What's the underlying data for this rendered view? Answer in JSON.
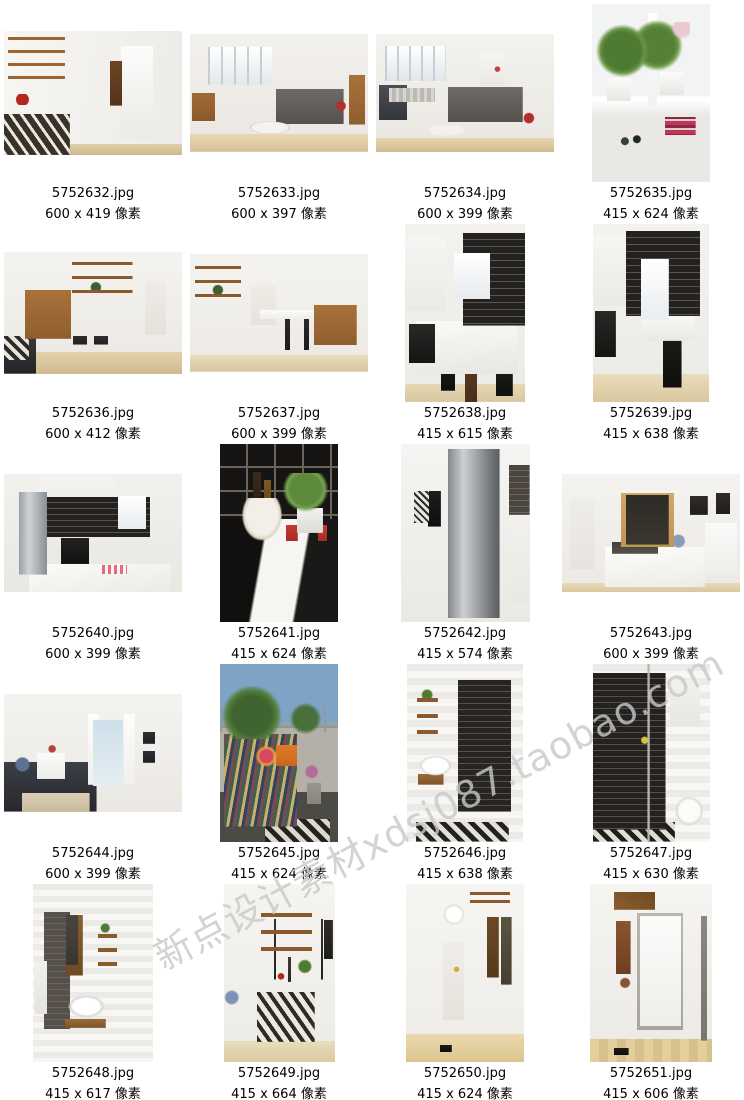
{
  "page": {
    "background": "#ffffff",
    "text_color": "#000000"
  },
  "watermark": {
    "text": "新点设计素材xdsj087.taobao.com",
    "color": "#c9c9c9"
  },
  "unit_label": "像素",
  "items": [
    {
      "filename": "5752632.jpg",
      "dims_label": "600 x 419 像素",
      "width": 600,
      "height": 419
    },
    {
      "filename": "5752633.jpg",
      "dims_label": "600 x 397 像素",
      "width": 600,
      "height": 397
    },
    {
      "filename": "5752634.jpg",
      "dims_label": "600 x 399 像素",
      "width": 600,
      "height": 399
    },
    {
      "filename": "5752635.jpg",
      "dims_label": "415 x 624 像素",
      "width": 415,
      "height": 624
    },
    {
      "filename": "5752636.jpg",
      "dims_label": "600 x 412 像素",
      "width": 600,
      "height": 412
    },
    {
      "filename": "5752637.jpg",
      "dims_label": "600 x 399 像素",
      "width": 600,
      "height": 399
    },
    {
      "filename": "5752638.jpg",
      "dims_label": "415 x 615 像素",
      "width": 415,
      "height": 615
    },
    {
      "filename": "5752639.jpg",
      "dims_label": "415 x 638 像素",
      "width": 415,
      "height": 638
    },
    {
      "filename": "5752640.jpg",
      "dims_label": "600 x 399 像素",
      "width": 600,
      "height": 399
    },
    {
      "filename": "5752641.jpg",
      "dims_label": "415 x 624 像素",
      "width": 415,
      "height": 624
    },
    {
      "filename": "5752642.jpg",
      "dims_label": "415 x 574 像素",
      "width": 415,
      "height": 574
    },
    {
      "filename": "5752643.jpg",
      "dims_label": "600 x 399 像素",
      "width": 600,
      "height": 399
    },
    {
      "filename": "5752644.jpg",
      "dims_label": "600 x 399 像素",
      "width": 600,
      "height": 399
    },
    {
      "filename": "5752645.jpg",
      "dims_label": "415 x 624 像素",
      "width": 415,
      "height": 624
    },
    {
      "filename": "5752646.jpg",
      "dims_label": "415 x 638 像素",
      "width": 415,
      "height": 638
    },
    {
      "filename": "5752647.jpg",
      "dims_label": "415 x 630 像素",
      "width": 415,
      "height": 630
    },
    {
      "filename": "5752648.jpg",
      "dims_label": "415 x 617 像素",
      "width": 415,
      "height": 617
    },
    {
      "filename": "5752649.jpg",
      "dims_label": "415 x 664 像素",
      "width": 415,
      "height": 664
    },
    {
      "filename": "5752650.jpg",
      "dims_label": "415 x 624 像素",
      "width": 415,
      "height": 624
    },
    {
      "filename": "5752651.jpg",
      "dims_label": "415 x 606 像素",
      "width": 415,
      "height": 606
    }
  ]
}
